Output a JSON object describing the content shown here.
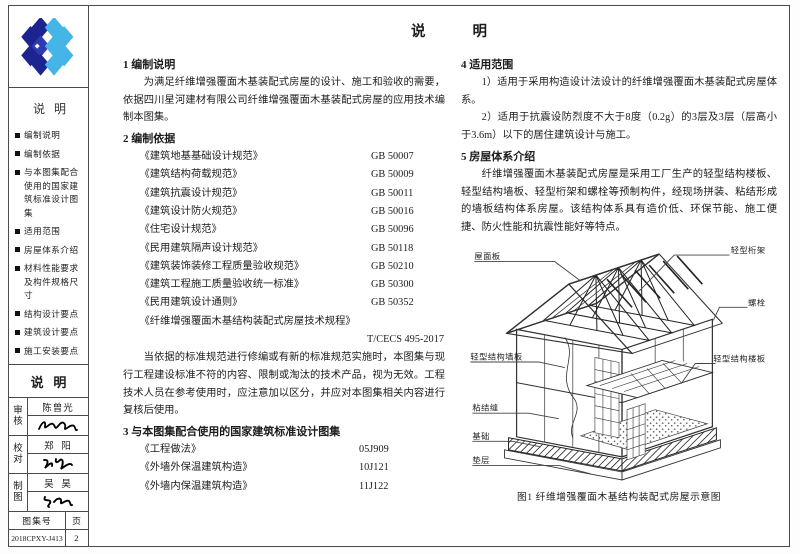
{
  "page": {
    "title": "说        明",
    "atlas_no_label": "图集号",
    "atlas_no": "2018CPXY-J413",
    "page_label": "页",
    "page_no": "2"
  },
  "sidebar": {
    "toc_title": "说  明",
    "items": [
      "编制说明",
      "编制依据",
      "与本图集配合使用的国家建筑标准设计图集",
      "适用范围",
      "房屋体系介绍",
      "材料性能要求及构件规格尺寸",
      "结构设计要点",
      "建筑设计要点",
      "施工安装要点"
    ],
    "stamp_title": "说   明",
    "titleblock": [
      {
        "role": "审核",
        "name": "陈曾光"
      },
      {
        "role": "校对",
        "name": "郑  阳"
      },
      {
        "role": "制图",
        "name": "吴  昊"
      }
    ]
  },
  "sections": {
    "s1": {
      "heading": "1 编制说明",
      "body": "为满足纤维增强覆面木基装配式房屋的设计、施工和验收的需要，依据四川星河建材有限公司纤维增强覆面木基装配式房屋的应用技术编制本图集。"
    },
    "s2": {
      "heading": "2 编制依据",
      "standards": [
        {
          "name": "《建筑地基基础设计规范》",
          "code": "GB 50007"
        },
        {
          "name": "《建筑结构荷载规范》",
          "code": "GB 50009"
        },
        {
          "name": "《建筑抗震设计规范》",
          "code": "GB 50011"
        },
        {
          "name": "《建筑设计防火规范》",
          "code": "GB 50016"
        },
        {
          "name": "《住宅设计规范》",
          "code": "GB 50096"
        },
        {
          "name": "《民用建筑隔声设计规范》",
          "code": "GB 50118"
        },
        {
          "name": "《建筑装饰装修工程质量验收规范》",
          "code": "GB 50210"
        },
        {
          "name": "《建筑工程施工质量验收统一标准》",
          "code": "GB 50300"
        },
        {
          "name": "《民用建筑设计通则》",
          "code": "GB 50352"
        }
      ],
      "last_standard_name": "《纤维增强覆面木基结构装配式房屋技术规程》",
      "last_standard_code": "T/CECS 495-2017",
      "note": "当依据的标准规范进行修编或有新的标准规范实施时，本图集与现行工程建设标准不符的内容、限制或淘汰的技术产品，视为无效。工程技术人员在参考使用时，应注意加以区分，并应对本图集相关内容进行复核后使用。"
    },
    "s3": {
      "heading": "3 与本图集配合使用的国家建筑标准设计图集",
      "atlases": [
        {
          "name": "《工程做法》",
          "code": "05J909"
        },
        {
          "name": "《外墙外保温建筑构造》",
          "code": "10J121"
        },
        {
          "name": "《外墙内保温建筑构造》",
          "code": "11J122"
        }
      ]
    },
    "s4": {
      "heading": "4 适用范围",
      "items": [
        "1）适用于采用构造设计法设计的纤维增强覆面木基装配式房屋体系。",
        "2）适用于抗震设防烈度不大于8度（0.2g）的3层及3层（层高小于3.6m）以下的居住建筑设计与施工。"
      ]
    },
    "s5": {
      "heading": "5 房屋体系介绍",
      "body": "纤维增强覆面木基装配式房屋是采用工厂生产的轻型结构楼板、轻型结构墙板、轻型桁架和螺栓等预制构件，经现场拼装、粘结形成的墙板结构体系房屋。该结构体系具有造价低、环保节能、施工便捷、防火性能和抗震性能好等特点。"
    }
  },
  "figure": {
    "caption": "图1 纤维增强覆面木基结构装配式房屋示意图",
    "labels": {
      "roof_panel": "屋面板",
      "wall_panel": "轻型结构墙板",
      "bond_joint": "粘结缝",
      "foundation": "基础",
      "bedding": "垫层",
      "truss": "轻型桁架",
      "bolt": "螺栓",
      "floor_panel": "轻型结构楼板"
    }
  },
  "logo": {
    "dark": "#1c2490",
    "mid": "#2e3ab0",
    "light": "#45b4e6"
  }
}
